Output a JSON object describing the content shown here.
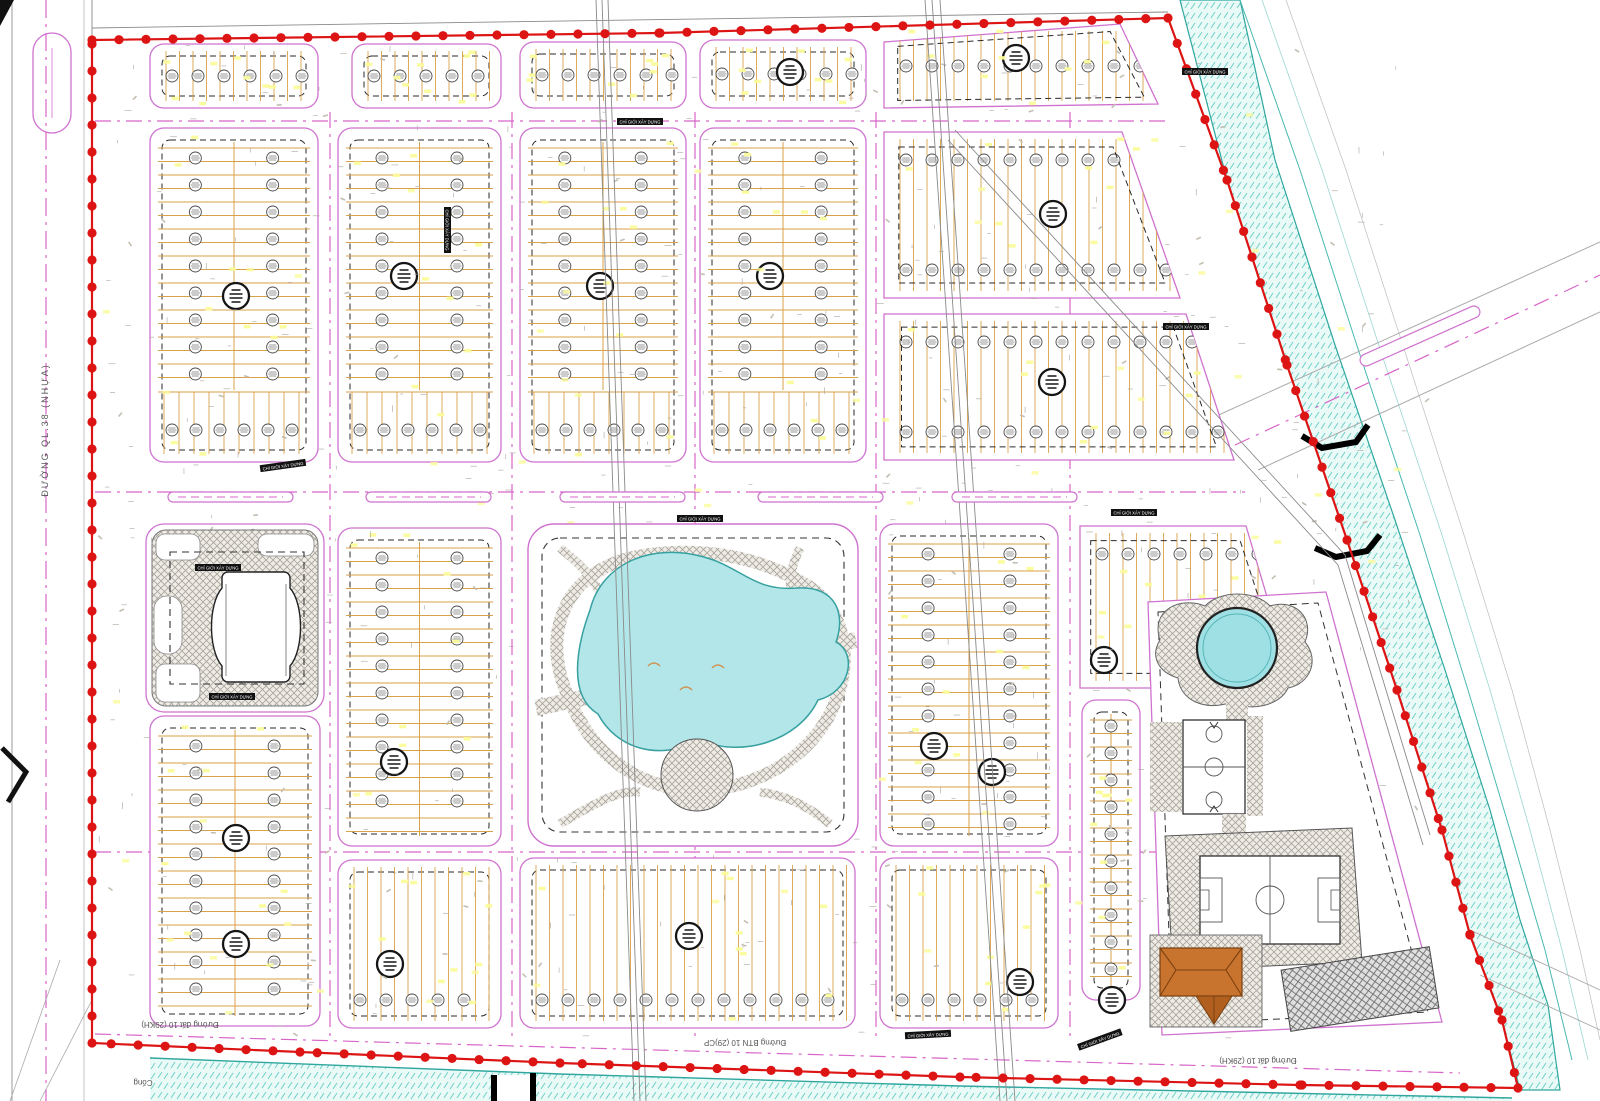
{
  "title": "Residential area detailed master plan drawing",
  "labels": {
    "highway_left": "ĐƯỜNG QL.38 (NHỰA)",
    "road_bottom_left": "Đường đất 10 (29KH)",
    "road_bottom_mid": "Đường BTN 10 (29)CP",
    "road_bottom_right": "Đường đất 10 (29KH)",
    "culvert": "Cống",
    "setback": "CHỈ GIỚI XÂY DỰNG"
  },
  "colors": {
    "boundary_red": "#dd1414",
    "block_pink": "#cf72cf",
    "centerline_pink": "#d864c8",
    "lot_tan": "#d8a24a",
    "water_teal": "#2fa79f",
    "pond_fill": "#b2e6e9",
    "hatch_gray": "#a8a49c",
    "text_gray": "#555555",
    "fleck_yellow": "#fbfb9a",
    "roof_brown": "#c9742e"
  },
  "boundary": {
    "points": [
      [
        92,
        40
      ],
      [
        660,
        33
      ],
      [
        1168,
        18
      ],
      [
        1227,
        180
      ],
      [
        1287,
        365
      ],
      [
        1347,
        540
      ],
      [
        1397,
        690
      ],
      [
        1442,
        830
      ],
      [
        1470,
        935
      ],
      [
        1502,
        1020
      ],
      [
        1518,
        1088
      ],
      [
        1300,
        1085
      ],
      [
        960,
        1077
      ],
      [
        560,
        1063
      ],
      [
        300,
        1052
      ],
      [
        92,
        1043
      ],
      [
        92,
        40
      ]
    ]
  },
  "blocks": [
    {
      "id": "strip-1",
      "rect": [
        150,
        44,
        168,
        64
      ],
      "orient": "v",
      "badges": "row"
    },
    {
      "id": "strip-2",
      "rect": [
        352,
        44,
        149,
        64
      ],
      "orient": "v",
      "badges": "row"
    },
    {
      "id": "strip-3",
      "rect": [
        520,
        42,
        166,
        66
      ],
      "orient": "v",
      "badges": "row"
    },
    {
      "id": "strip-4",
      "rect": [
        700,
        40,
        166,
        68
      ],
      "orient": "v",
      "badges": "row"
    },
    {
      "id": "strip-5",
      "poly": [
        [
          884,
          42
        ],
        [
          1120,
          24
        ],
        [
          1158,
          104
        ],
        [
          884,
          108
        ]
      ],
      "orient": "v",
      "badges": "row"
    },
    {
      "id": "b-r2c1",
      "rect": [
        150,
        128,
        168,
        334
      ],
      "orient": "h",
      "strip": true
    },
    {
      "id": "b-r2c2",
      "rect": [
        338,
        128,
        163,
        334
      ],
      "orient": "h",
      "strip": true
    },
    {
      "id": "b-r2c3",
      "rect": [
        520,
        128,
        166,
        334
      ],
      "orient": "h",
      "strip": true
    },
    {
      "id": "b-r2c4",
      "rect": [
        700,
        128,
        166,
        334
      ],
      "orient": "h",
      "strip": true
    },
    {
      "id": "b-r2c5a",
      "poly": [
        [
          884,
          132
        ],
        [
          1122,
          132
        ],
        [
          1180,
          298
        ],
        [
          884,
          298
        ]
      ],
      "orient": "v",
      "badges": "rows2"
    },
    {
      "id": "b-r2c5b",
      "poly": [
        [
          884,
          314
        ],
        [
          1186,
          314
        ],
        [
          1234,
          460
        ],
        [
          884,
          460
        ]
      ],
      "orient": "v",
      "badges": "rows2"
    },
    {
      "id": "b-r3c1",
      "rect": [
        150,
        716,
        170,
        310
      ],
      "orient": "h"
    },
    {
      "id": "b-r3c2",
      "rect": [
        338,
        528,
        163,
        318
      ],
      "orient": "h"
    },
    {
      "id": "b-r3c4",
      "rect": [
        880,
        524,
        178,
        322
      ],
      "orient": "h"
    },
    {
      "id": "b-r3c5",
      "poly": [
        [
          1080,
          526
        ],
        [
          1246,
          526
        ],
        [
          1294,
          688
        ],
        [
          1080,
          688
        ]
      ],
      "orient": "v",
      "badges": "rowTop"
    },
    {
      "id": "b-r4c2",
      "rect": [
        338,
        860,
        163,
        168
      ],
      "orient": "v",
      "badges": "rowBottom"
    },
    {
      "id": "b-r4c3",
      "rect": [
        520,
        858,
        335,
        170
      ],
      "orient": "v",
      "badges": "rowBottom"
    },
    {
      "id": "b-r4c4",
      "rect": [
        880,
        858,
        178,
        170
      ],
      "orient": "v",
      "badges": "rowBottom"
    },
    {
      "id": "b-c6",
      "rect": [
        1082,
        700,
        58,
        300
      ],
      "orient": "h",
      "badges": "col1"
    }
  ],
  "diag_row": {
    "p1": [
      1283,
      618
    ],
    "p2": [
      1345,
      805
    ],
    "halfw": 14,
    "step": 19
  },
  "dark_badges": [
    [
      236,
      296
    ],
    [
      404,
      276
    ],
    [
      600,
      286
    ],
    [
      770,
      276
    ],
    [
      1053,
      214
    ],
    [
      1052,
      382
    ],
    [
      790,
      72
    ],
    [
      1016,
      58
    ],
    [
      236,
      838
    ],
    [
      236,
      944
    ],
    [
      394,
      762
    ],
    [
      934,
      746
    ],
    [
      992,
      772
    ],
    [
      1104,
      660
    ],
    [
      390,
      964
    ],
    [
      689,
      936
    ],
    [
      1020,
      982
    ],
    [
      1112,
      1000
    ],
    [
      700,
      688
    ],
    [
      256,
      618
    ],
    [
      1228,
      996
    ],
    [
      1360,
      1000
    ],
    [
      1245,
      885
    ]
  ],
  "medians": {
    "y": 497,
    "xs": [
      168,
      366,
      560,
      758,
      952
    ],
    "w": 125,
    "h": 10
  },
  "setback_tags": [
    [
      283,
      466,
      -8
    ],
    [
      218,
      568,
      0
    ],
    [
      232,
      697,
      0
    ],
    [
      700,
      519,
      0
    ],
    [
      928,
      1035,
      -3
    ],
    [
      1100,
      1040,
      -20
    ],
    [
      1186,
      327,
      0
    ],
    [
      640,
      122,
      0
    ],
    [
      447,
      230,
      90
    ],
    [
      1134,
      513,
      0
    ],
    [
      1205,
      72,
      0
    ]
  ],
  "centerlines": {
    "vertical_x": [
      330,
      512,
      695,
      876,
      1070
    ],
    "horizontal": [
      [
        95,
        121,
        1165,
        121
      ],
      [
        95,
        492,
        1245,
        492
      ],
      [
        95,
        852,
        1305,
        852
      ],
      [
        95,
        1034,
        1460,
        1073
      ]
    ],
    "highway_x": 46
  }
}
